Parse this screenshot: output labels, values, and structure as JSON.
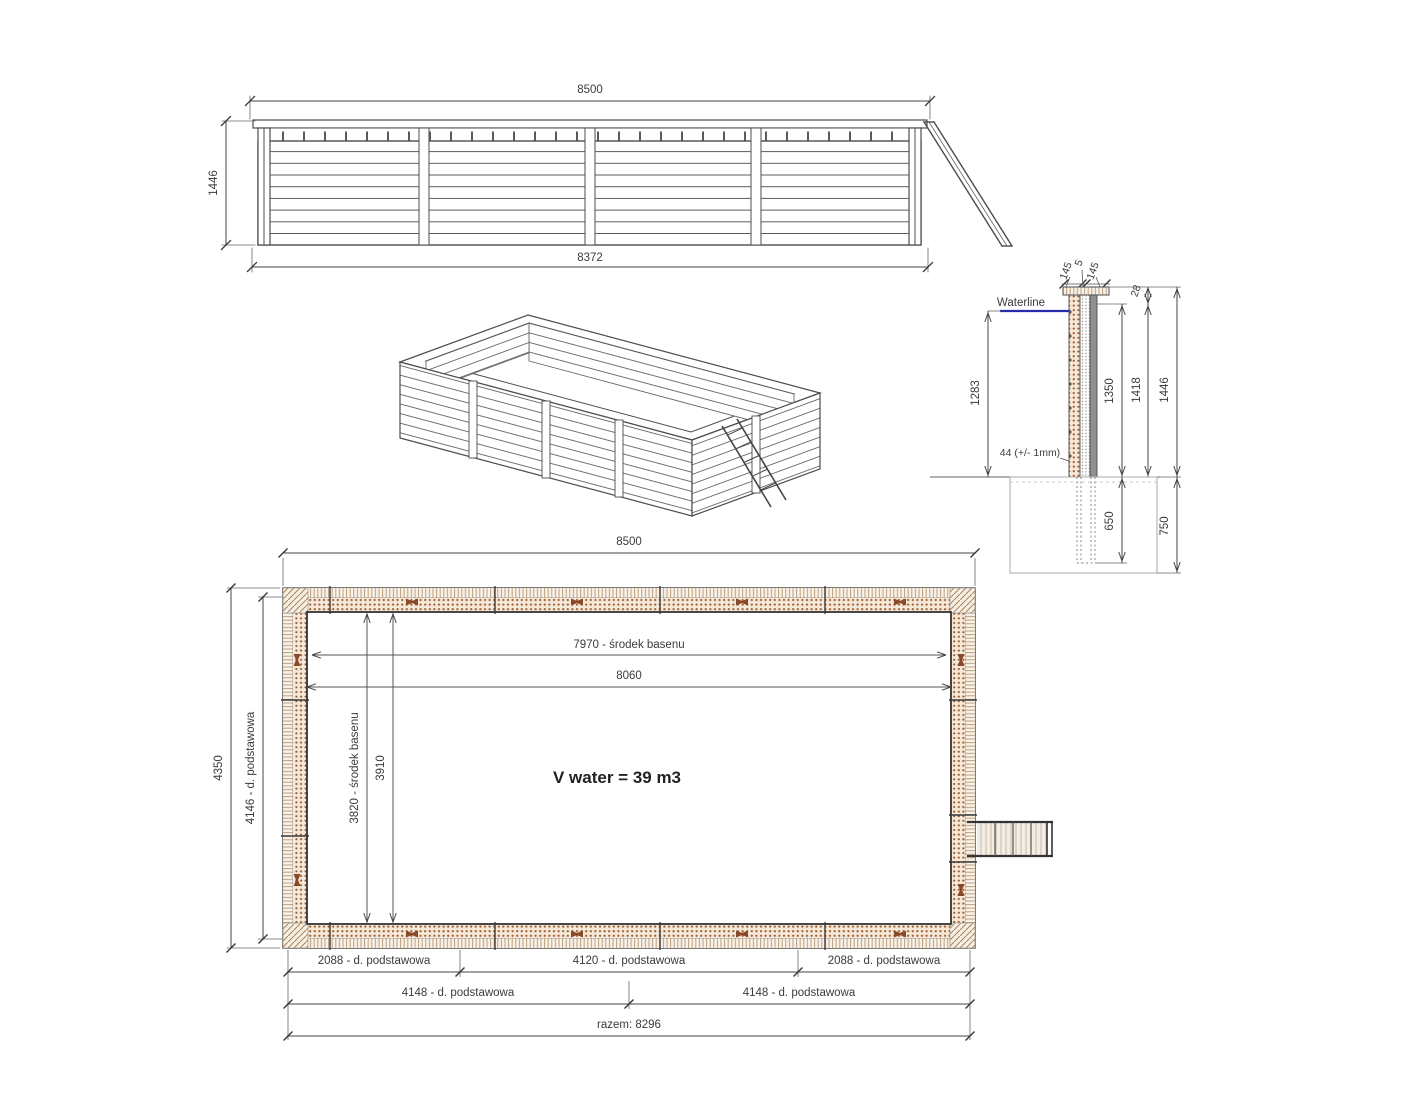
{
  "elevation": {
    "dim_width_top": "8500",
    "dim_height": "1446",
    "dim_width_bottom": "8372"
  },
  "section": {
    "dim_cap_left": "145",
    "dim_cap_center": "5",
    "dim_cap_right": "145",
    "dim_cap_thickness": "28",
    "waterline_label": "Waterline",
    "dim_waterline_depth": "1283",
    "plank_note": "44 (+/- 1mm)",
    "dim_boards_height": "1350",
    "dim_wall_no_cap": "1418",
    "dim_total_height": "1446",
    "dim_post_embed": "650",
    "dim_foundation_depth": "750"
  },
  "plan": {
    "dim_width": "8500",
    "dim_height_outer": "4350",
    "dim_height_base": "4146 - d. podstawowa",
    "dim_inner_center_h": "7970 - środek basenu",
    "dim_inner_width": "8060",
    "dim_inner_center_v": "3820 - środek basenu",
    "dim_inner_height": "3910",
    "volume_label": "V water = 39 m3",
    "bottom_row1": [
      "2088 - d. podstawowa",
      "4120 - d. podstawowa",
      "2088 - d. podstawowa"
    ],
    "bottom_row2": [
      "4148 - d. podstawowa",
      "4148 - d. podstawowa"
    ],
    "bottom_total": "razem: 8296"
  }
}
